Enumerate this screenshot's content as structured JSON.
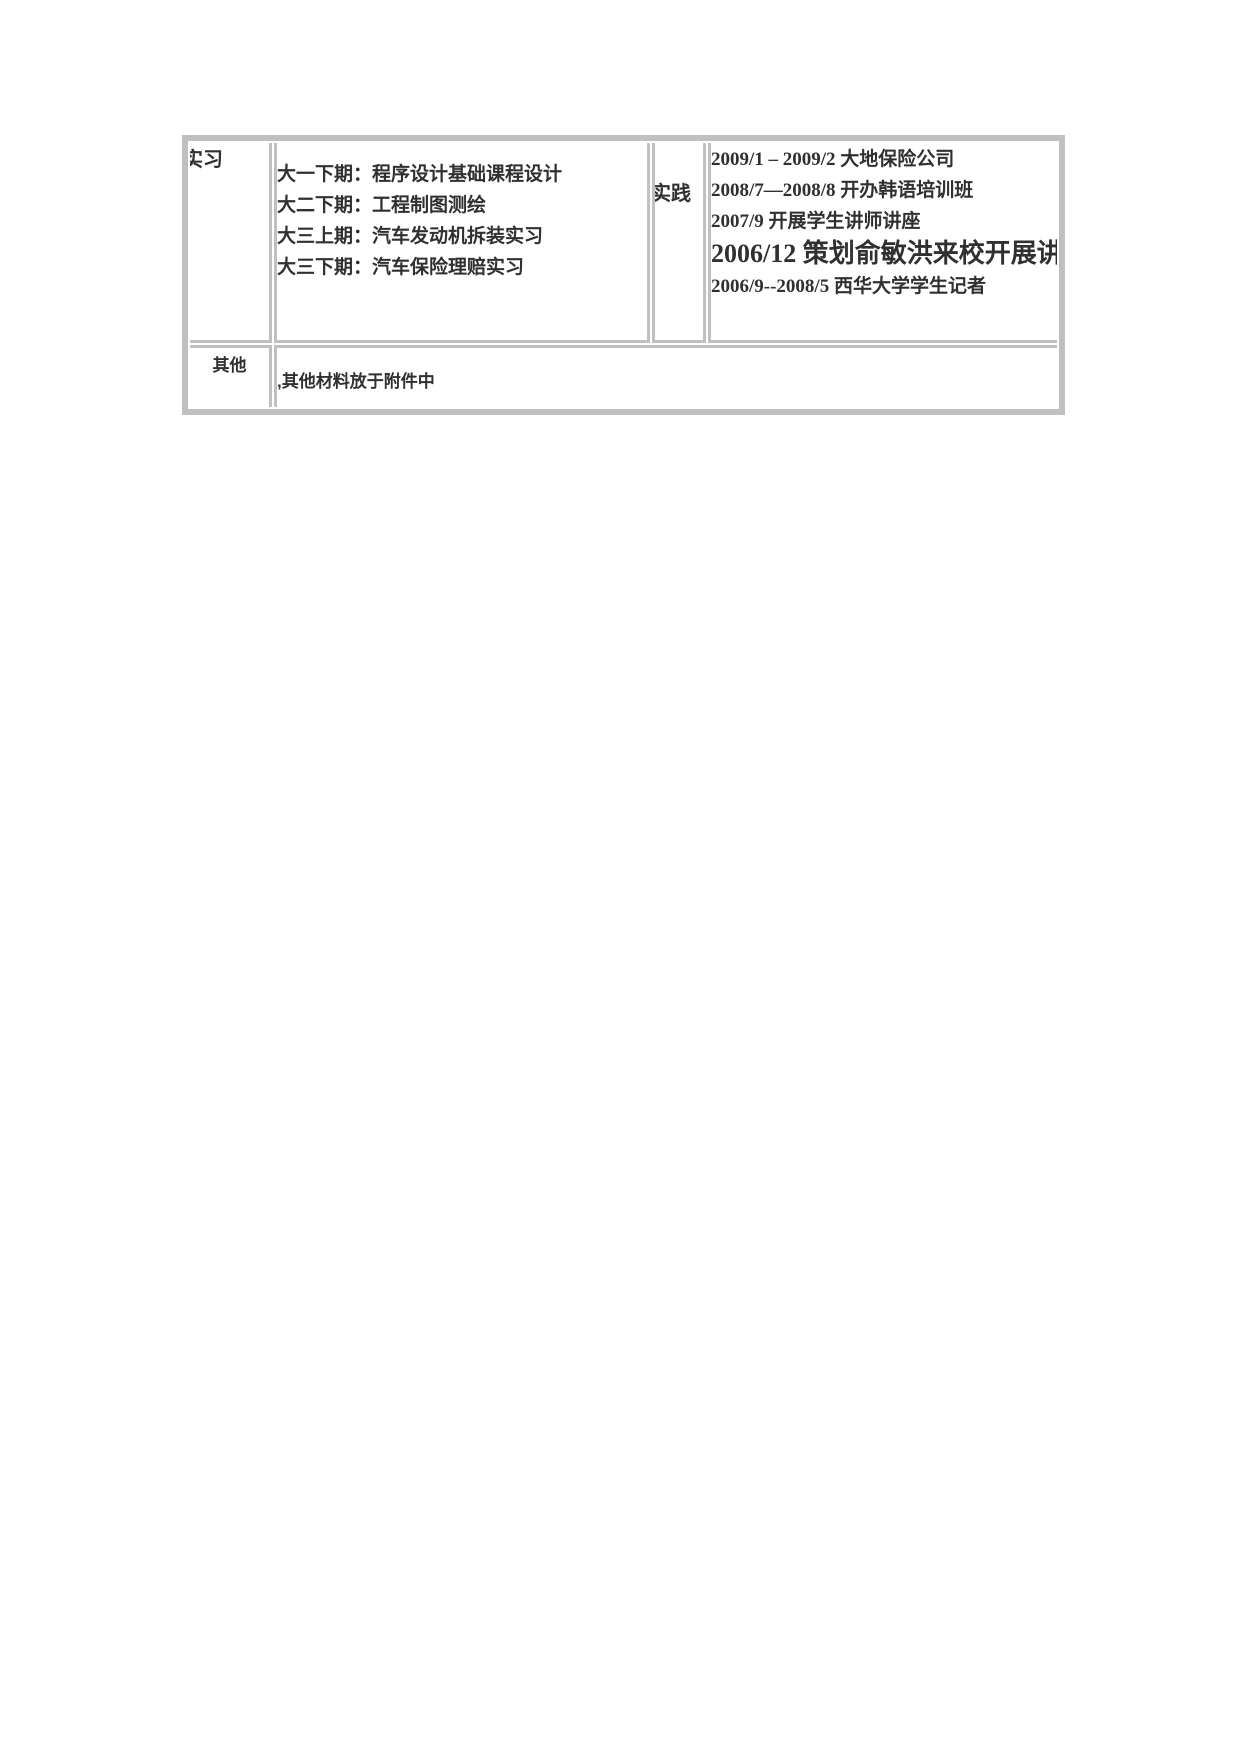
{
  "page": {
    "background_color": "#ffffff"
  },
  "table": {
    "border_color": "#c0c0c0",
    "text_color": "#303030",
    "internship": {
      "label": "实习",
      "items": [
        "大一下期：程序设计基础课程设计",
        "大二下期：工程制图测绘",
        "大三上期：汽车发动机拆装实习",
        "大三下期：汽车保险理赔实习"
      ]
    },
    "practice": {
      "label": "实践",
      "items": [
        "2009/1 – 2009/2 大地保险公司",
        "2008/7—2008/8 开办韩语培训班",
        "2007/9 开展学生讲师讲座",
        "2006/12 策划俞敏洪来校开展讲座",
        "2006/9--2008/5 西华大学学生记者"
      ],
      "large_item_index": 3
    },
    "other": {
      "label": "其他",
      "content": ",其他材料放于附件中"
    }
  }
}
